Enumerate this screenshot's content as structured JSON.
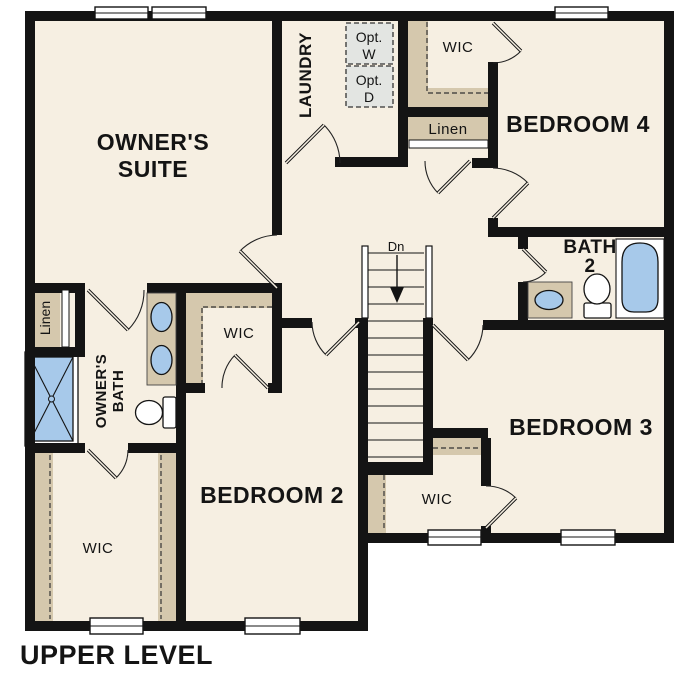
{
  "plan": {
    "title": "UPPER LEVEL",
    "level": "upper",
    "colors": {
      "floor": "#f6efe2",
      "shelf_tan": "#d5c8ad",
      "fixture_blue": "#a7c9ea",
      "wall_black": "#141414",
      "optional_gray": "#e3e5e2"
    },
    "labels": {
      "owners_suite_line1": "OWNER'S",
      "owners_suite_line2": "SUITE",
      "laundry": "LAUNDRY",
      "opt_line": "Opt.",
      "opt_w": "W",
      "opt_d": "D",
      "wic": "WIC",
      "linen": "Linen",
      "bedroom4": "BEDROOM 4",
      "bath2_line1": "BATH",
      "bath2_line2": "2",
      "bedroom3": "BEDROOM 3",
      "bedroom2": "BEDROOM 2",
      "owners_bath_line1": "OWNER'S",
      "owners_bath_line2": "BATH",
      "stairs_down": "Dn"
    }
  }
}
